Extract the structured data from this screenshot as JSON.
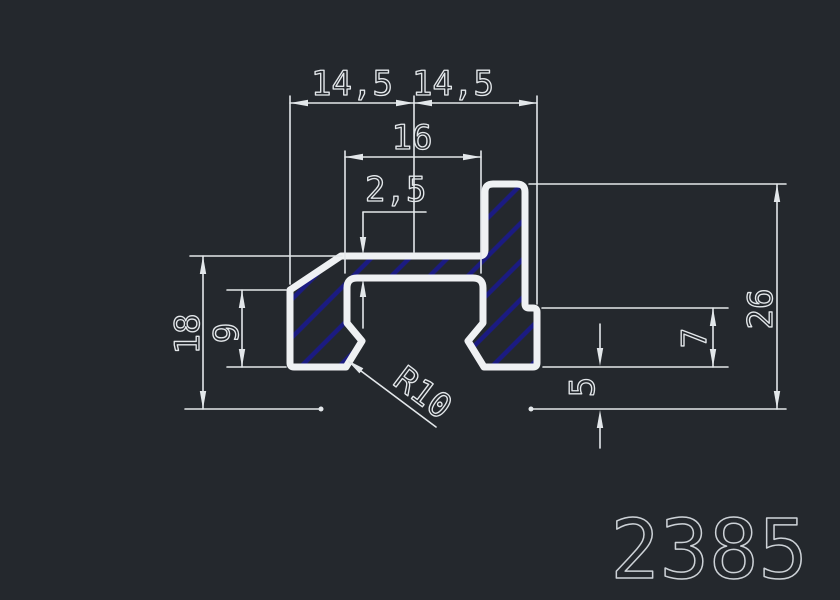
{
  "drawing": {
    "part_number": "2385",
    "labels": {
      "top_left": "14,5",
      "top_right": "14,5",
      "slot_width": "16",
      "web_thickness": "2,5",
      "left_total_height": "18",
      "left_arm_height": "9",
      "total_height": "26",
      "step_height": "7",
      "base_offset": "5",
      "radius": "R10"
    },
    "colors": {
      "background": "#24282d",
      "outline": "#eff1f3",
      "dim_lines": "#e3e7ea",
      "hatch": "#1b1b82",
      "dim_text": "#e3e7ea",
      "part_number": "#cdd2d7"
    }
  }
}
